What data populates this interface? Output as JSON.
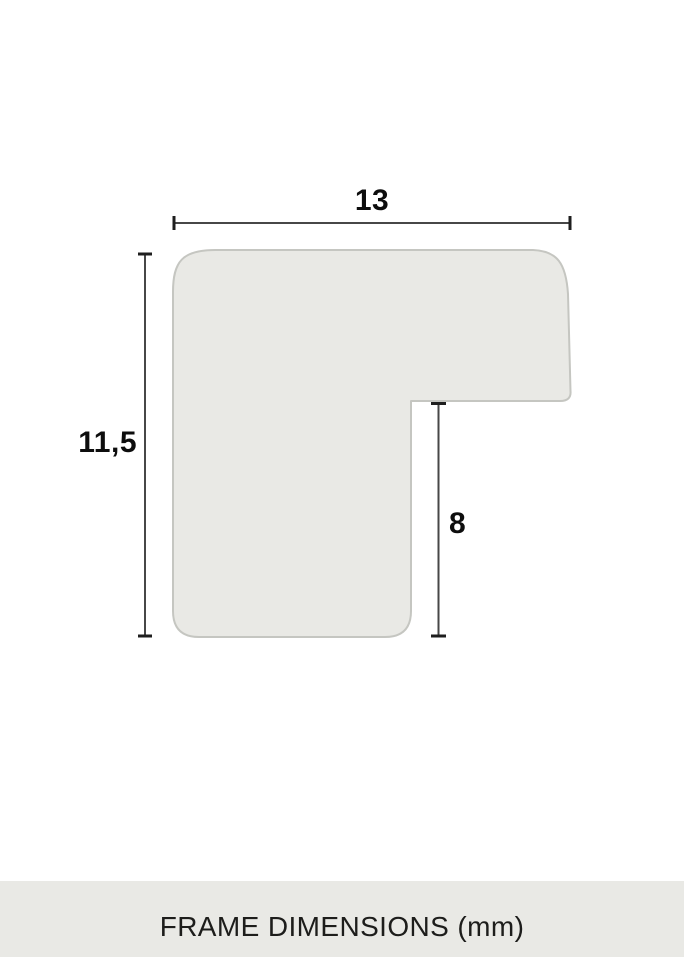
{
  "diagram": {
    "caption": "FRAME DIMENSIONS (mm)",
    "unit": "mm",
    "dimension_labels": {
      "width": "13",
      "height": "11,5",
      "rabbet_depth": "8"
    },
    "dimension_values_mm": {
      "width": 13,
      "height": 11.5,
      "rabbet_depth": 8
    },
    "colors": {
      "page_background": "#ffffff",
      "profile_fill": "#e9e9e5",
      "profile_stroke": "#c5c6c1",
      "dimension_line": "#474747",
      "dimension_tick": "#1e1e1e",
      "label_text": "#0d0d0d",
      "caption_background": "#e9e9e5",
      "caption_text": "#1d1d1b"
    }
  }
}
